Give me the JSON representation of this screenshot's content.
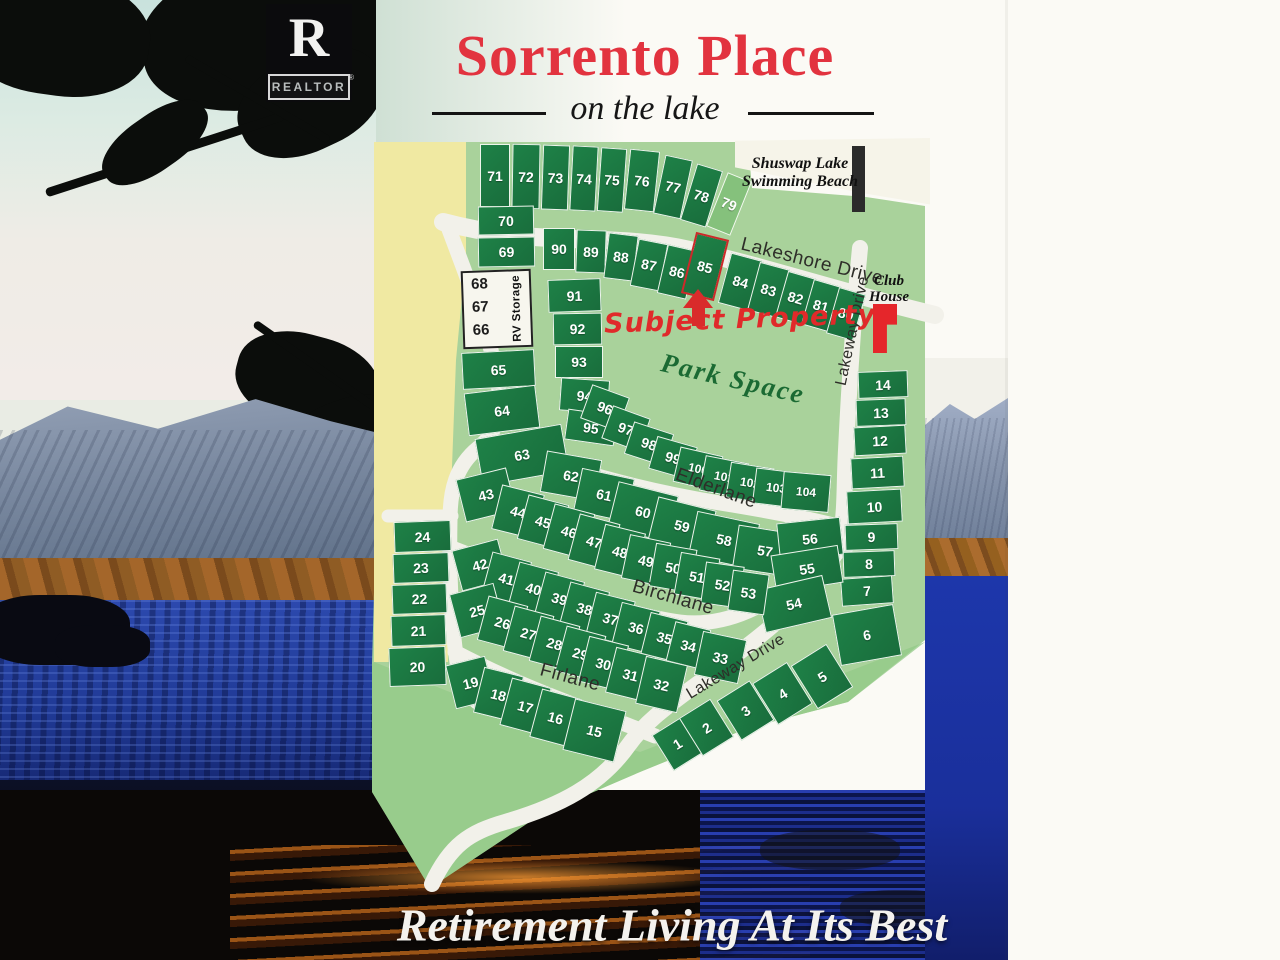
{
  "header": {
    "title": "Sorrento Place",
    "subtitle": "on the lake",
    "realtor": {
      "letter": "R",
      "label": "REALTOR",
      "reg": "®"
    }
  },
  "footer": {
    "slogan": "Retirement Living At Its Best"
  },
  "map": {
    "labels": {
      "beach_line1": "Shuswap Lake",
      "beach_line2": "Swimming Beach",
      "club_line1": "Club",
      "club_line2": "House",
      "park": "Park Space",
      "subject_property": "Subject  Property",
      "rv_storage": "RV Storage"
    },
    "rv_lots": [
      "68",
      "67",
      "66"
    ],
    "streets": [
      {
        "label": "Lakeshore Drive",
        "x": 812,
        "y": 262,
        "r": 14,
        "s": 19
      },
      {
        "label": "Lakeway Drive",
        "x": 853,
        "y": 331,
        "r": -78,
        "s": 16
      },
      {
        "label": "Elderlane",
        "x": 716,
        "y": 489,
        "r": 20,
        "s": 19
      },
      {
        "label": "Birchlane",
        "x": 673,
        "y": 598,
        "r": 16,
        "s": 19
      },
      {
        "label": "Firlane",
        "x": 570,
        "y": 678,
        "r": 15,
        "s": 19
      },
      {
        "label": "Lakeway Drive",
        "x": 736,
        "y": 667,
        "r": -31,
        "s": 16
      }
    ],
    "lots": [
      {
        "n": "71",
        "x": 480,
        "y": 144,
        "w": 30,
        "h": 63,
        "r": 0
      },
      {
        "n": "72",
        "x": 512,
        "y": 144,
        "w": 28,
        "h": 65,
        "r": 1
      },
      {
        "n": "73",
        "x": 542,
        "y": 145,
        "w": 27,
        "h": 65,
        "r": 2
      },
      {
        "n": "74",
        "x": 571,
        "y": 146,
        "w": 26,
        "h": 65,
        "r": 3
      },
      {
        "n": "75",
        "x": 599,
        "y": 148,
        "w": 26,
        "h": 64,
        "r": 4
      },
      {
        "n": "76",
        "x": 627,
        "y": 150,
        "w": 30,
        "h": 61,
        "r": 6
      },
      {
        "n": "77",
        "x": 659,
        "y": 157,
        "w": 28,
        "h": 60,
        "r": 12
      },
      {
        "n": "78",
        "x": 688,
        "y": 166,
        "w": 27,
        "h": 59,
        "r": 17
      },
      {
        "n": "79",
        "x": 716,
        "y": 175,
        "w": 26,
        "h": 58,
        "r": 22,
        "t": "light"
      },
      {
        "n": "70",
        "x": 478,
        "y": 206,
        "w": 56,
        "h": 29,
        "r": -1
      },
      {
        "n": "69",
        "x": 478,
        "y": 237,
        "w": 57,
        "h": 30,
        "r": -1
      },
      {
        "n": "65",
        "x": 462,
        "y": 351,
        "w": 73,
        "h": 37,
        "r": -3
      },
      {
        "n": "64",
        "x": 466,
        "y": 389,
        "w": 72,
        "h": 43,
        "r": -7
      },
      {
        "n": "90",
        "x": 543,
        "y": 228,
        "w": 32,
        "h": 42,
        "r": 0
      },
      {
        "n": "89",
        "x": 576,
        "y": 230,
        "w": 30,
        "h": 43,
        "r": 2
      },
      {
        "n": "88",
        "x": 606,
        "y": 234,
        "w": 30,
        "h": 46,
        "r": 7
      },
      {
        "n": "87",
        "x": 634,
        "y": 241,
        "w": 30,
        "h": 48,
        "r": 11
      },
      {
        "n": "86",
        "x": 662,
        "y": 247,
        "w": 30,
        "h": 50,
        "r": 13
      },
      {
        "n": "85",
        "x": 688,
        "y": 235,
        "w": 34,
        "h": 63,
        "r": 14,
        "t": "red"
      },
      {
        "n": "84",
        "x": 724,
        "y": 256,
        "w": 33,
        "h": 52,
        "r": 15
      },
      {
        "n": "83",
        "x": 753,
        "y": 265,
        "w": 31,
        "h": 50,
        "r": 15
      },
      {
        "n": "82",
        "x": 781,
        "y": 274,
        "w": 29,
        "h": 48,
        "r": 16
      },
      {
        "n": "81",
        "x": 807,
        "y": 282,
        "w": 28,
        "h": 47,
        "r": 16
      },
      {
        "n": "80",
        "x": 832,
        "y": 290,
        "w": 28,
        "h": 48,
        "r": 16
      },
      {
        "n": "91",
        "x": 548,
        "y": 279,
        "w": 53,
        "h": 33,
        "r": -2
      },
      {
        "n": "92",
        "x": 553,
        "y": 313,
        "w": 49,
        "h": 32,
        "r": -1
      },
      {
        "n": "93",
        "x": 555,
        "y": 346,
        "w": 48,
        "h": 32,
        "r": 0
      },
      {
        "n": "94",
        "x": 560,
        "y": 379,
        "w": 49,
        "h": 33,
        "r": 4
      },
      {
        "n": "95",
        "x": 566,
        "y": 412,
        "w": 50,
        "h": 31,
        "r": 8
      },
      {
        "n": "96",
        "x": 585,
        "y": 390,
        "w": 40,
        "h": 36,
        "r": 20
      },
      {
        "n": "97",
        "x": 606,
        "y": 411,
        "w": 40,
        "h": 35,
        "r": 20
      },
      {
        "n": "98",
        "x": 628,
        "y": 427,
        "w": 42,
        "h": 34,
        "r": 18
      },
      {
        "n": "99",
        "x": 652,
        "y": 441,
        "w": 42,
        "h": 34,
        "r": 16
      },
      {
        "n": "100",
        "x": 676,
        "y": 451,
        "w": 44,
        "h": 36,
        "r": 13
      },
      {
        "n": "101",
        "x": 702,
        "y": 459,
        "w": 44,
        "h": 36,
        "r": 11
      },
      {
        "n": "102",
        "x": 728,
        "y": 465,
        "w": 44,
        "h": 36,
        "r": 9
      },
      {
        "n": "103",
        "x": 754,
        "y": 470,
        "w": 44,
        "h": 36,
        "r": 7
      },
      {
        "n": "104",
        "x": 782,
        "y": 473,
        "w": 48,
        "h": 38,
        "r": 5
      },
      {
        "n": "14",
        "x": 858,
        "y": 371,
        "w": 50,
        "h": 27,
        "r": -2
      },
      {
        "n": "13",
        "x": 856,
        "y": 399,
        "w": 50,
        "h": 27,
        "r": -2
      },
      {
        "n": "12",
        "x": 854,
        "y": 426,
        "w": 52,
        "h": 29,
        "r": -3
      },
      {
        "n": "11",
        "x": 851,
        "y": 457,
        "w": 53,
        "h": 31,
        "r": -3
      },
      {
        "n": "10",
        "x": 847,
        "y": 490,
        "w": 55,
        "h": 33,
        "r": -3
      },
      {
        "n": "9",
        "x": 845,
        "y": 524,
        "w": 53,
        "h": 26,
        "r": -2
      },
      {
        "n": "8",
        "x": 843,
        "y": 551,
        "w": 52,
        "h": 26,
        "r": -2
      },
      {
        "n": "7",
        "x": 841,
        "y": 577,
        "w": 52,
        "h": 28,
        "r": -4
      },
      {
        "n": "6",
        "x": 836,
        "y": 609,
        "w": 62,
        "h": 52,
        "r": -10
      },
      {
        "n": "24",
        "x": 394,
        "y": 521,
        "w": 57,
        "h": 31,
        "r": -2
      },
      {
        "n": "23",
        "x": 393,
        "y": 553,
        "w": 56,
        "h": 30,
        "r": -2
      },
      {
        "n": "22",
        "x": 392,
        "y": 584,
        "w": 55,
        "h": 30,
        "r": -2
      },
      {
        "n": "21",
        "x": 391,
        "y": 615,
        "w": 55,
        "h": 31,
        "r": -2
      },
      {
        "n": "20",
        "x": 389,
        "y": 647,
        "w": 57,
        "h": 39,
        "r": -2
      },
      {
        "n": "63",
        "x": 478,
        "y": 431,
        "w": 88,
        "h": 48,
        "r": -10
      },
      {
        "n": "62",
        "x": 543,
        "y": 455,
        "w": 56,
        "h": 42,
        "r": 10
      },
      {
        "n": "61",
        "x": 577,
        "y": 473,
        "w": 54,
        "h": 44,
        "r": 12
      },
      {
        "n": "60",
        "x": 612,
        "y": 488,
        "w": 62,
        "h": 48,
        "r": 14
      },
      {
        "n": "59",
        "x": 652,
        "y": 503,
        "w": 60,
        "h": 46,
        "r": 14
      },
      {
        "n": "58",
        "x": 692,
        "y": 517,
        "w": 64,
        "h": 46,
        "r": 12
      },
      {
        "n": "57",
        "x": 735,
        "y": 529,
        "w": 60,
        "h": 44,
        "r": 9
      },
      {
        "n": "56",
        "x": 778,
        "y": 520,
        "w": 64,
        "h": 38,
        "r": -6
      },
      {
        "n": "55",
        "x": 773,
        "y": 550,
        "w": 68,
        "h": 38,
        "r": -9
      },
      {
        "n": "54",
        "x": 760,
        "y": 582,
        "w": 68,
        "h": 44,
        "r": -13
      },
      {
        "n": "43",
        "x": 460,
        "y": 473,
        "w": 52,
        "h": 44,
        "r": -14
      },
      {
        "n": "44",
        "x": 496,
        "y": 489,
        "w": 44,
        "h": 46,
        "r": 14
      },
      {
        "n": "45",
        "x": 522,
        "y": 499,
        "w": 42,
        "h": 46,
        "r": 15
      },
      {
        "n": "46",
        "x": 548,
        "y": 508,
        "w": 42,
        "h": 47,
        "r": 15
      },
      {
        "n": "47",
        "x": 573,
        "y": 518,
        "w": 42,
        "h": 48,
        "r": 15
      },
      {
        "n": "48",
        "x": 599,
        "y": 528,
        "w": 42,
        "h": 47,
        "r": 14
      },
      {
        "n": "49",
        "x": 625,
        "y": 538,
        "w": 42,
        "h": 45,
        "r": 12
      },
      {
        "n": "50",
        "x": 652,
        "y": 546,
        "w": 42,
        "h": 44,
        "r": 10
      },
      {
        "n": "51",
        "x": 677,
        "y": 555,
        "w": 40,
        "h": 43,
        "r": 10
      },
      {
        "n": "52",
        "x": 703,
        "y": 564,
        "w": 39,
        "h": 42,
        "r": 8
      },
      {
        "n": "53",
        "x": 730,
        "y": 572,
        "w": 37,
        "h": 41,
        "r": 8
      },
      {
        "n": "42",
        "x": 456,
        "y": 544,
        "w": 48,
        "h": 42,
        "r": -15
      },
      {
        "n": "41",
        "x": 486,
        "y": 556,
        "w": 41,
        "h": 45,
        "r": 15
      },
      {
        "n": "40",
        "x": 513,
        "y": 566,
        "w": 41,
        "h": 45,
        "r": 15
      },
      {
        "n": "39",
        "x": 539,
        "y": 576,
        "w": 41,
        "h": 45,
        "r": 15
      },
      {
        "n": "38",
        "x": 564,
        "y": 586,
        "w": 41,
        "h": 45,
        "r": 15
      },
      {
        "n": "37",
        "x": 590,
        "y": 596,
        "w": 41,
        "h": 45,
        "r": 14
      },
      {
        "n": "36",
        "x": 616,
        "y": 606,
        "w": 40,
        "h": 44,
        "r": 14
      },
      {
        "n": "35",
        "x": 645,
        "y": 616,
        "w": 39,
        "h": 43,
        "r": 14
      },
      {
        "n": "34",
        "x": 670,
        "y": 625,
        "w": 37,
        "h": 41,
        "r": 14
      },
      {
        "n": "33",
        "x": 698,
        "y": 635,
        "w": 45,
        "h": 45,
        "r": 12
      },
      {
        "n": "25",
        "x": 454,
        "y": 588,
        "w": 46,
        "h": 45,
        "r": -15
      },
      {
        "n": "26",
        "x": 482,
        "y": 600,
        "w": 41,
        "h": 46,
        "r": 15
      },
      {
        "n": "27",
        "x": 508,
        "y": 610,
        "w": 41,
        "h": 47,
        "r": 15
      },
      {
        "n": "28",
        "x": 534,
        "y": 620,
        "w": 41,
        "h": 47,
        "r": 15
      },
      {
        "n": "29",
        "x": 560,
        "y": 630,
        "w": 41,
        "h": 47,
        "r": 15
      },
      {
        "n": "30",
        "x": 583,
        "y": 640,
        "w": 41,
        "h": 47,
        "r": 14
      },
      {
        "n": "31",
        "x": 610,
        "y": 651,
        "w": 41,
        "h": 47,
        "r": 14
      },
      {
        "n": "32",
        "x": 640,
        "y": 660,
        "w": 43,
        "h": 49,
        "r": 13
      },
      {
        "n": "19",
        "x": 450,
        "y": 660,
        "w": 41,
        "h": 45,
        "r": -14
      },
      {
        "n": "18",
        "x": 478,
        "y": 671,
        "w": 41,
        "h": 47,
        "r": 14
      },
      {
        "n": "17",
        "x": 505,
        "y": 682,
        "w": 41,
        "h": 49,
        "r": 15
      },
      {
        "n": "16",
        "x": 535,
        "y": 693,
        "w": 41,
        "h": 50,
        "r": 15
      },
      {
        "n": "15",
        "x": 568,
        "y": 704,
        "w": 53,
        "h": 53,
        "r": 14
      },
      {
        "n": "1",
        "x": 660,
        "y": 723,
        "w": 35,
        "h": 42,
        "r": -32
      },
      {
        "n": "2",
        "x": 688,
        "y": 705,
        "w": 37,
        "h": 45,
        "r": -32
      },
      {
        "n": "3",
        "x": 726,
        "y": 687,
        "w": 39,
        "h": 47,
        "r": -32
      },
      {
        "n": "4",
        "x": 762,
        "y": 669,
        "w": 41,
        "h": 49,
        "r": -32
      },
      {
        "n": "5",
        "x": 801,
        "y": 651,
        "w": 42,
        "h": 51,
        "r": -32
      }
    ]
  },
  "colors": {
    "lot_green": "#1e8147",
    "map_green": "#a9d29b",
    "band_yellow": "#f0e9a2",
    "road_cream": "#f2f1ea",
    "accent_red": "#e02a2a",
    "title_red": "#e2333f"
  }
}
